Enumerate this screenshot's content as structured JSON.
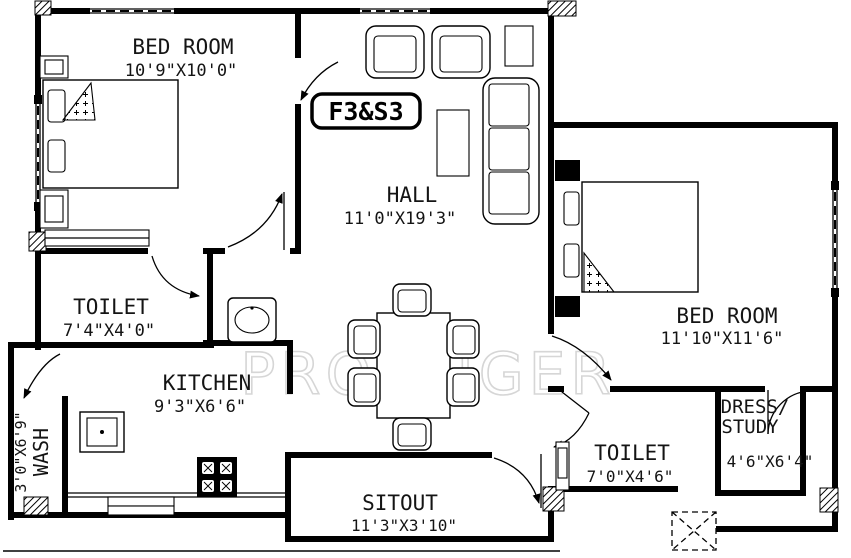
{
  "page": {
    "background": "#ffffff",
    "line_color": "#000000",
    "watermark_color": "#d6d6d6"
  },
  "unit_label": "F3&S3",
  "watermark": "PROPTIGER",
  "rooms": {
    "bedroom1": {
      "name": "BED ROOM",
      "dims": "10'9\"X10'0\""
    },
    "hall": {
      "name": "HALL",
      "dims": "11'0\"X19'3\""
    },
    "toilet1": {
      "name": "TOILET",
      "dims": "7'4\"X4'0\""
    },
    "kitchen": {
      "name": "KITCHEN",
      "dims": "9'3\"X6'6\""
    },
    "wash": {
      "name": "WASH",
      "dims": "3'0\"X6'9\""
    },
    "sitout": {
      "name": "SITOUT",
      "dims": "11'3\"X3'10\""
    },
    "bedroom2": {
      "name": "BED ROOM",
      "dims": "11'10\"X11'6\""
    },
    "toilet2": {
      "name": "TOILET",
      "dims": "7'0\"X4'6\""
    },
    "dress_study": {
      "name_line1": "DRESS/",
      "name_line2": "STUDY",
      "dims": "4'6\"X6'4\""
    }
  }
}
